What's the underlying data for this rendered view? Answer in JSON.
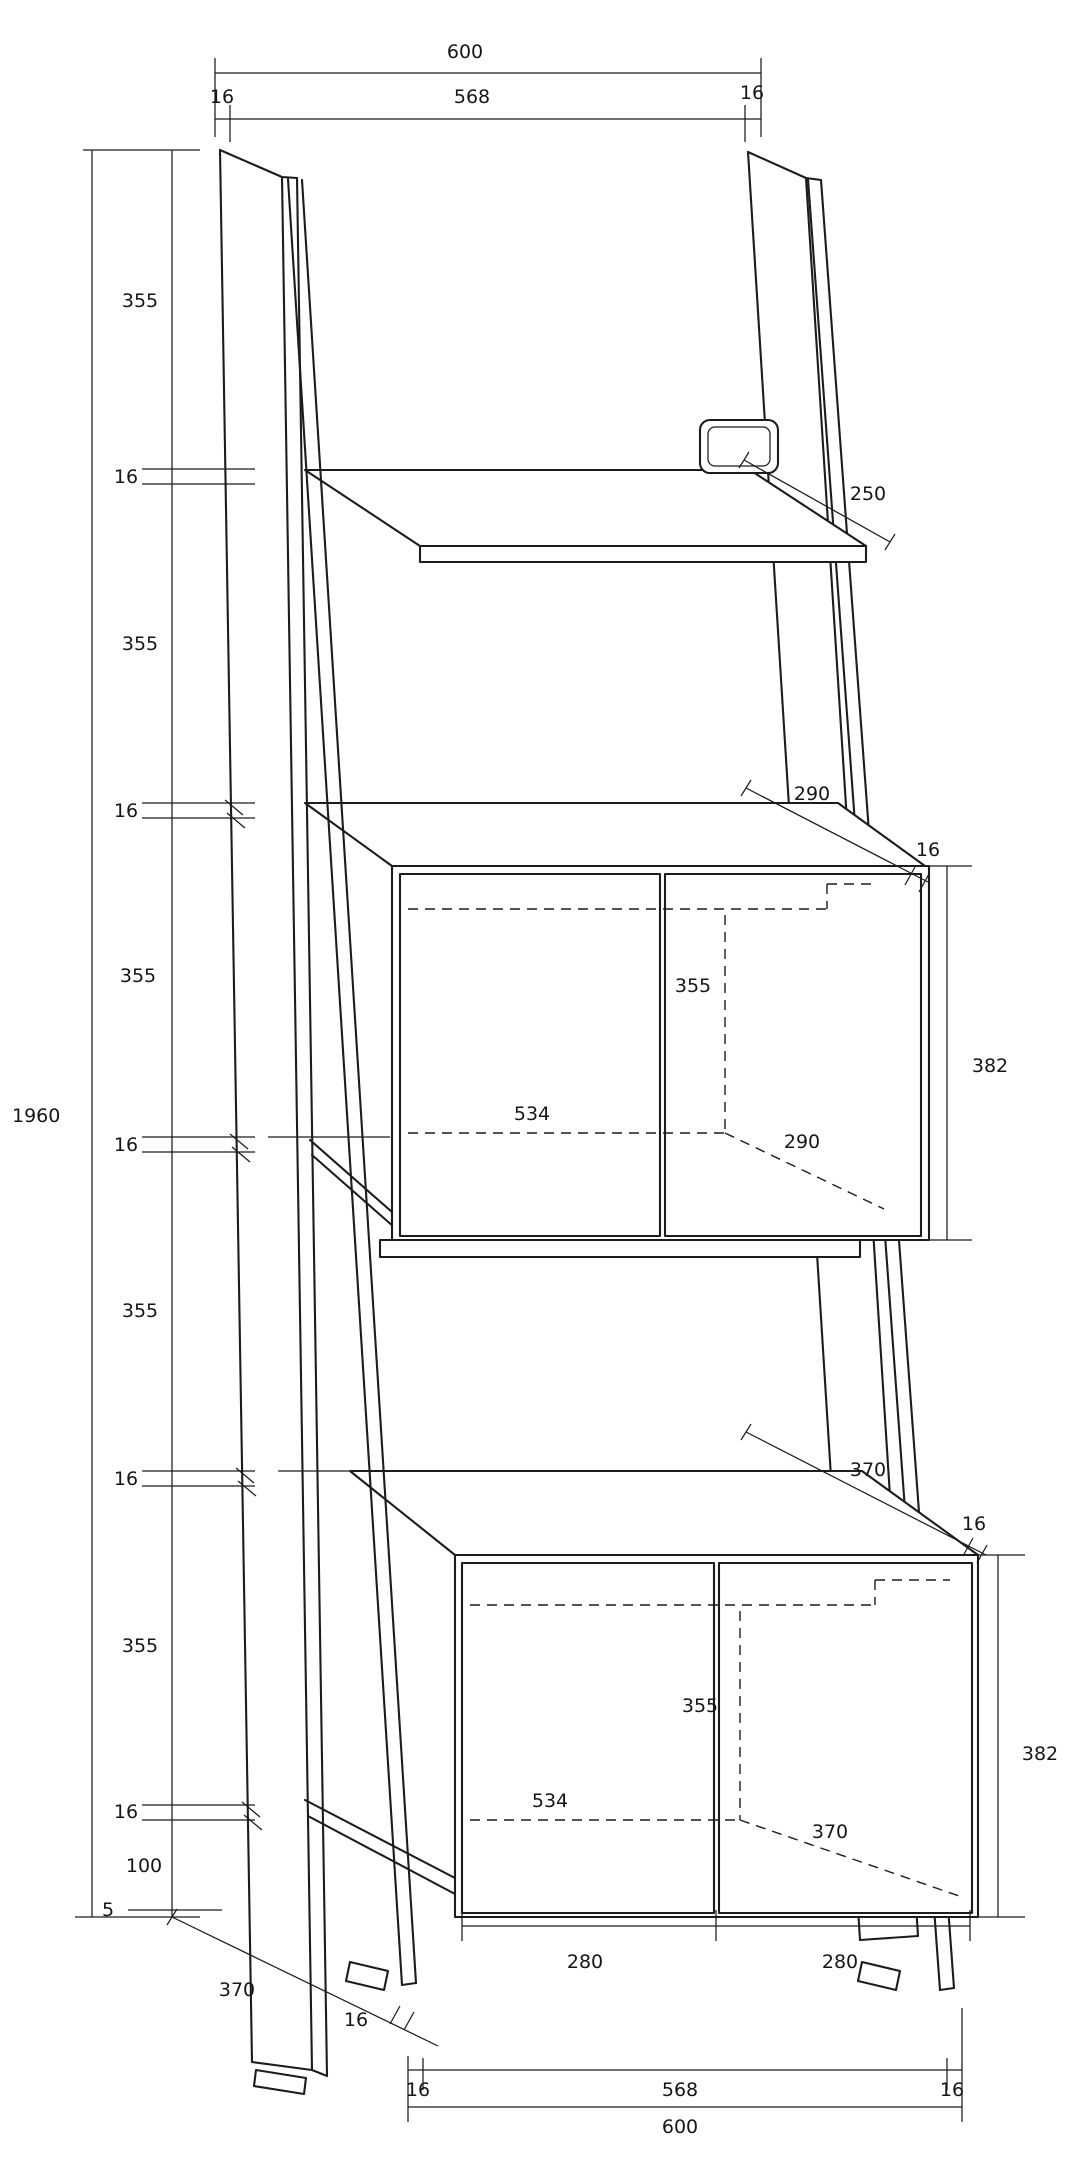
{
  "meta": {
    "kind": "furniture dimension drawing",
    "background": "#ffffff",
    "line_color": "#1c1c1c"
  },
  "labels": {
    "top_overall": "600",
    "top_left": "16",
    "top_inner": "568",
    "top_right": "16",
    "left_seg1": "355",
    "left_t1": "16",
    "left_seg2": "355",
    "left_t2": "16",
    "left_seg3": "355",
    "left_t3": "16",
    "left_seg4": "355",
    "left_t4": "16",
    "left_seg5": "355",
    "left_t5": "16",
    "left_100": "100",
    "left_5": "5",
    "overall_height": "1960",
    "top_shelf_depth": "250",
    "mid_depth": "290",
    "mid_thick": "16",
    "mid_height": "382",
    "mid_door_h": "355",
    "mid_door_w": "534",
    "mid_inner_depth": "290",
    "bot_depth": "370",
    "bot_thick": "16",
    "bot_height": "382",
    "bot_door_h": "355",
    "bot_door_w": "534",
    "bot_inner_depth": "370",
    "bot_door_left": "280",
    "bot_door_right": "280",
    "foot_thick": "16",
    "base_left": "16",
    "base_inner": "568",
    "base_right": "16",
    "base_overall": "600",
    "base_leg_depth": "370"
  }
}
